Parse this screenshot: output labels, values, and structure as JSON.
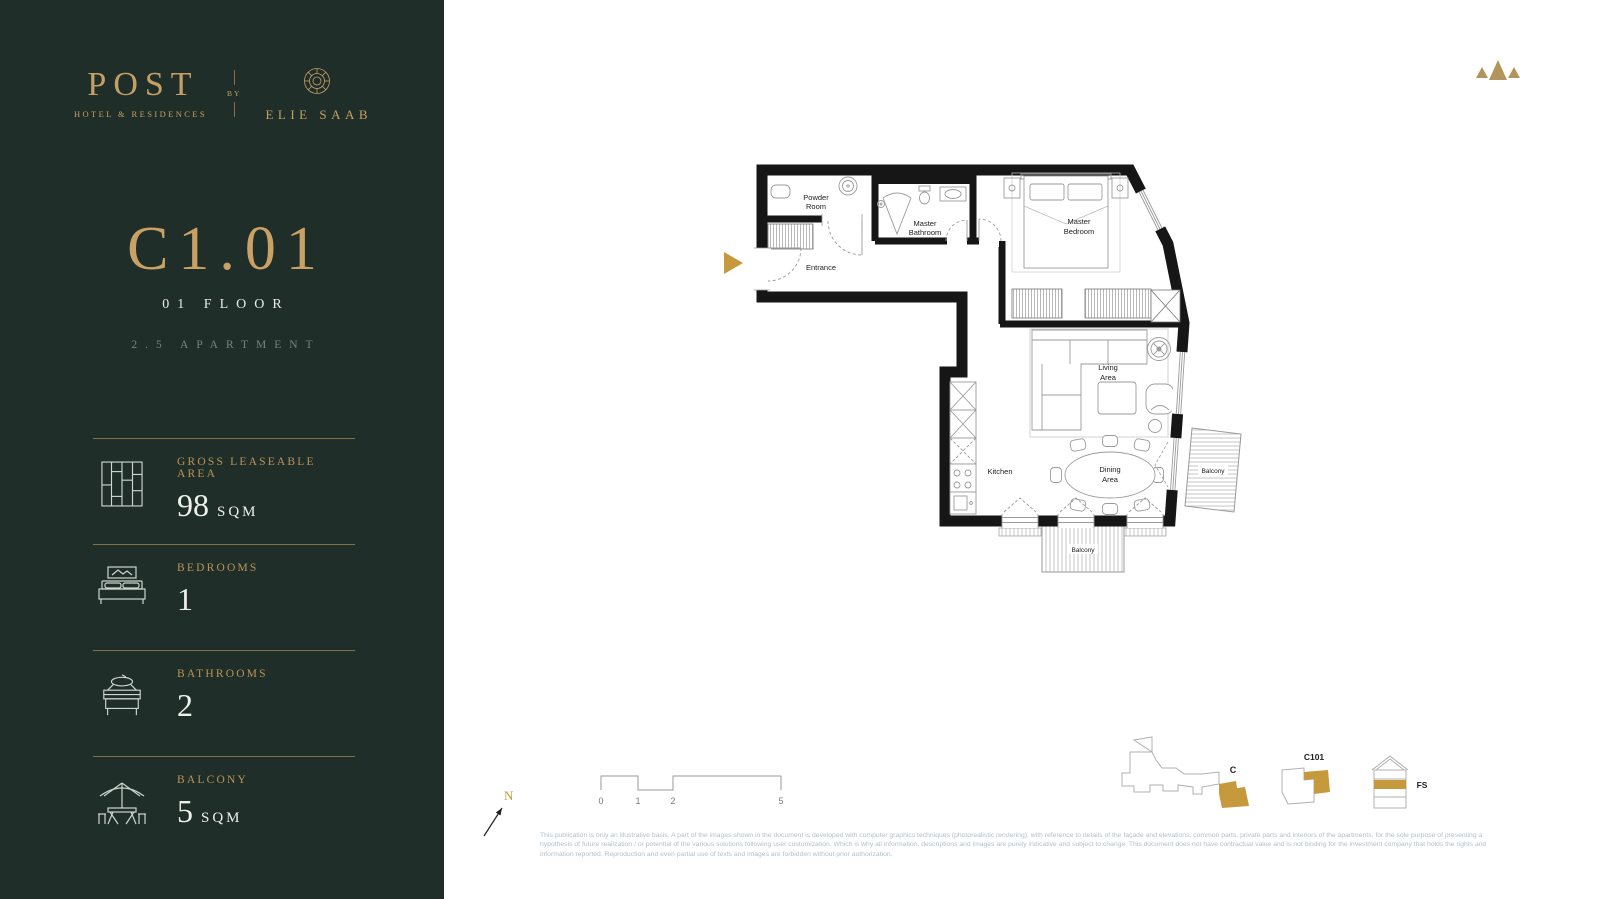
{
  "brand": {
    "name": "POST",
    "tagline": "HOTEL & RESIDENCES",
    "by": "BY",
    "partner": "ELIE SAAB"
  },
  "unit": {
    "code": "C1.01",
    "floor": "01 FLOOR",
    "type": "2.5 APARTMENT"
  },
  "stats": [
    {
      "label": "GROSS LEASEABLE AREA",
      "value": "98",
      "unit": "SQM"
    },
    {
      "label": "BEDROOMS",
      "value": "1",
      "unit": ""
    },
    {
      "label": "BATHROOMS",
      "value": "2",
      "unit": ""
    },
    {
      "label": "BALCONY",
      "value": "5",
      "unit": "SQM"
    }
  ],
  "plan": {
    "rooms": {
      "powder_1": "Powder",
      "powder_2": "Room",
      "entrance": "Entrance",
      "master_bath_1": "Master",
      "master_bath_2": "Bathroom",
      "master_bed_1": "Master",
      "master_bed_2": "Bedroom",
      "living_1": "Living",
      "living_2": "Area",
      "kitchen": "Kitchen",
      "dining_1": "Dining",
      "dining_2": "Area",
      "balcony_bottom": "Balcony",
      "balcony_right": "Balcony"
    },
    "north": "N",
    "scale": [
      "0",
      "1",
      "2",
      "5"
    ]
  },
  "minimaps": {
    "site": "C",
    "block": "C101",
    "elevation": "FS"
  },
  "footer": {
    "disclaimer": [
      "This publication is only an illustrative basis. A part of the images shown in the document is developed with computer graphics techniques (photorealistic rendering), with reference to details of the façade and elevations, common parts, private parts and interiors of the apartments, for the sole purpose of presenting a",
      "hypothesis of future realization / or potential of the various solutions following user customization. Which is why all information, descriptions and images are purely indicative and subject to change. This document does not have contractual value and is not binding for the investment company that holds the rights and",
      "information reported. Reproduction and even partial use of texts and images are forbidden without prior authorization."
    ]
  },
  "colors": {
    "sidebar_bg": "#202e29",
    "gold": "#c5a064",
    "gold_accent": "#c6993d",
    "wall": "#161616"
  }
}
